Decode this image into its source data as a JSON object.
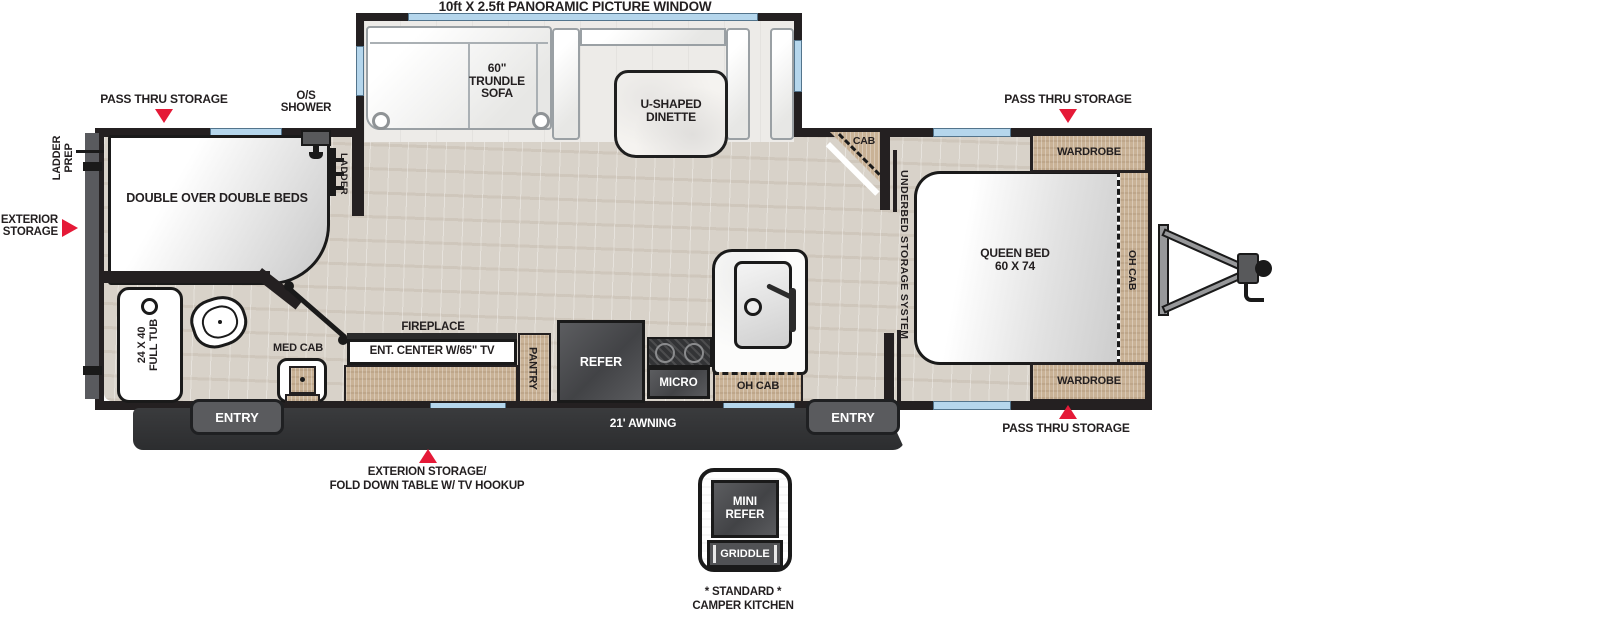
{
  "colors": {
    "wall": "#242021",
    "floor": "#d8d2c9",
    "wood": "#c9b296",
    "window": "#b5d6ec",
    "red": "#e51937",
    "appliance": "#4a4b4e",
    "awning": "#2f3032",
    "slide_floor": "#edebe8"
  },
  "labels": {
    "panoramic_window": "10ft X 2.5ft PANORAMIC PICTURE WINDOW",
    "pass_thru_storage": "PASS THRU STORAGE",
    "os_shower": [
      "O/S",
      "SHOWER"
    ],
    "ladder_prep": [
      "LADDER",
      "PREP"
    ],
    "exterior_storage": [
      "EXTERIOR",
      "STORAGE"
    ],
    "trundle_sofa": [
      "60\"",
      "TRUNDLE",
      "SOFA"
    ],
    "dinette": [
      "U-SHAPED",
      "DINETTE"
    ],
    "double_beds": "DOUBLE OVER DOUBLE BEDS",
    "ladder": "LADDER",
    "cab": "CAB",
    "underbed": "UNDERBED STORAGE SYSTEM",
    "queen_bed": [
      "QUEEN BED",
      "60 X 74"
    ],
    "wardrobe": "WARDROBE",
    "oh_cab": "OH CAB",
    "tub": [
      "24 X 40",
      "FULL TUB"
    ],
    "med_cab": "MED CAB",
    "fireplace": "FIREPLACE",
    "ent_center": "ENT. CENTER W/65\" TV",
    "pantry": "PANTRY",
    "refer": "REFER",
    "micro": "MICRO",
    "entry": "ENTRY",
    "awning": "21' AWNING",
    "fold_down_table": [
      "EXTERION STORAGE/",
      "FOLD DOWN TABLE W/ TV HOOKUP"
    ],
    "camper_kitchen": {
      "mini_refer": [
        "MINI",
        "REFER"
      ],
      "griddle": "GRIDDLE",
      "caption": [
        "* STANDARD *",
        "CAMPER KITCHEN"
      ]
    }
  }
}
